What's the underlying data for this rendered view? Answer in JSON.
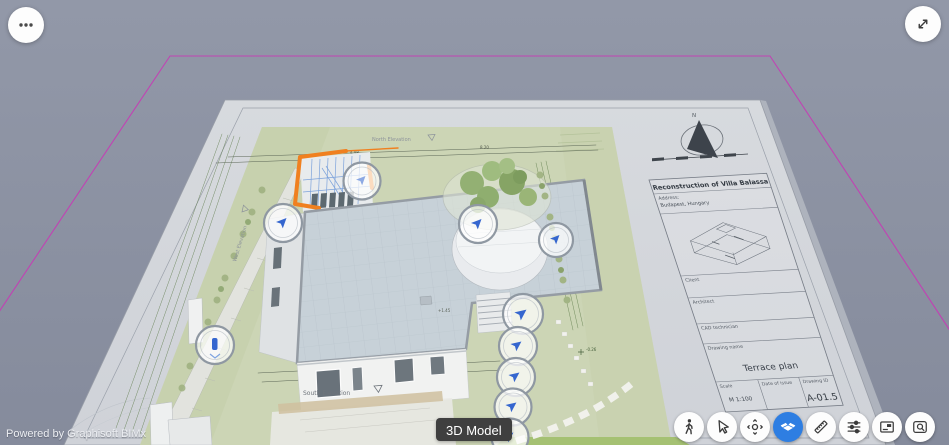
{
  "viewer": {
    "powered_by": "Powered by Graphisoft BIMx",
    "tooltip": "3D Model"
  },
  "top_controls": {
    "menu_icon": "more-options-ellipsis",
    "fullscreen_icon": "expand-diagonal-arrows"
  },
  "toolbar": {
    "active_item": "3d-model",
    "active_color": "#2e7ee2",
    "items": [
      "walk-icon",
      "select-cursor-icon",
      "look-around-icon",
      "3d-model-icon",
      "measure-ruler-icon",
      "settings-sliders-icon",
      "layouts-sheet-icon",
      "find-on-layout-icon"
    ]
  },
  "sheet": {
    "title_block": {
      "project_title": "Reconstruction of Villa Balassa",
      "address_label": "Address:",
      "address_value": "Budapest, Hungary",
      "client_label": "Client",
      "architect_label": "Architect",
      "cad_label": "CAD technician",
      "drawing_name_label": "Drawing name",
      "drawing_name_value": "Terrace plan",
      "scale_label": "Scale",
      "scale_value": "M 1:100",
      "date_label": "Date of issue",
      "drawing_id_label": "Drawing ID",
      "drawing_id_value": "A-01.5"
    },
    "annotations": {
      "north_elevation": "North Elevation",
      "south_elevation": "South Elevation",
      "west_elevation": "West Elevation",
      "compass_north": "N"
    },
    "dimensions": {
      "south": [
        "4.44",
        "1.52",
        "62",
        "4.71",
        "9.60"
      ],
      "north": [
        "4.98",
        "8.20"
      ]
    },
    "levels": {
      "roof": "+1.45",
      "garden": "-0.26"
    }
  },
  "scene": {
    "viewpoint_markers": 10,
    "selection_color": "#f0801f",
    "marker_arrow_color": "#3566cf",
    "boundary_color": "#c63ab5"
  }
}
